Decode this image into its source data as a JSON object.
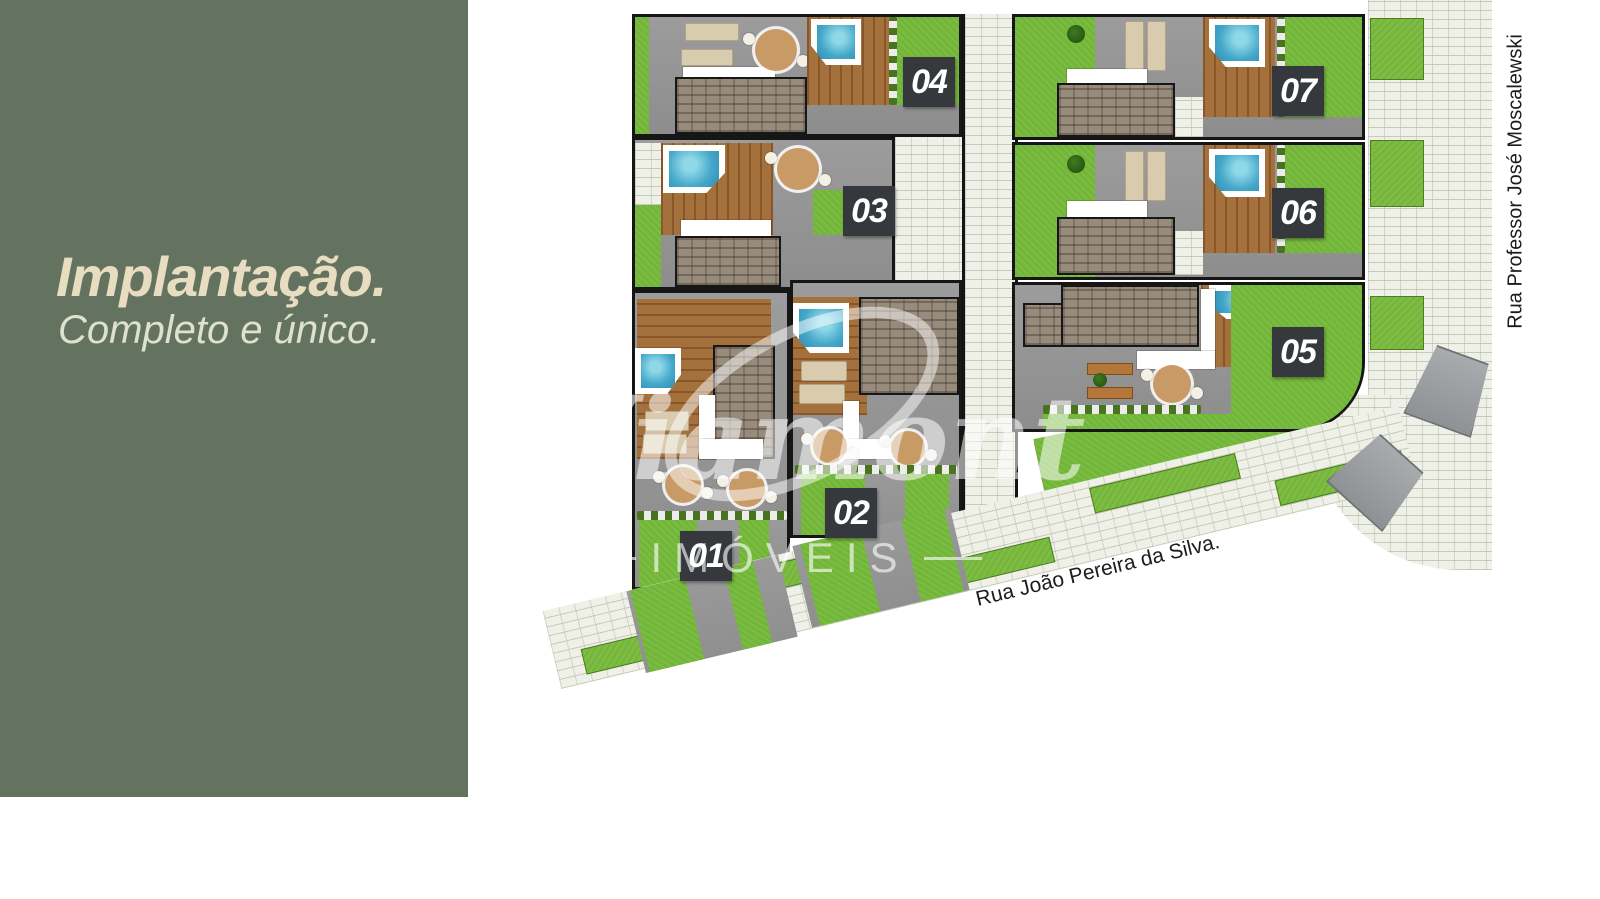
{
  "left_panel": {
    "title": "Implantação.",
    "subtitle": "Completo e único.",
    "bg_color": "#64735f",
    "title_color": "#e8dcc1",
    "subtitle_color": "#dde1cd"
  },
  "site_plan": {
    "units": [
      {
        "id": "unit-01",
        "label": "01"
      },
      {
        "id": "unit-02",
        "label": "02"
      },
      {
        "id": "unit-03",
        "label": "03"
      },
      {
        "id": "unit-04",
        "label": "04"
      },
      {
        "id": "unit-05",
        "label": "05"
      },
      {
        "id": "unit-06",
        "label": "06"
      },
      {
        "id": "unit-07",
        "label": "07"
      }
    ],
    "streets": [
      {
        "name": "Rua João Pereira da Silva.",
        "position": "bottom"
      },
      {
        "name": "Rua Professor José Moscalewski",
        "position": "right"
      }
    ],
    "badge_color": "#35383d",
    "lawn_color": "#72b637",
    "pool_color": "#45a8c9",
    "walkway_color": "#eff0e7"
  },
  "watermark": {
    "brand": "Viamont",
    "subtext": "IMÓVEIS"
  }
}
